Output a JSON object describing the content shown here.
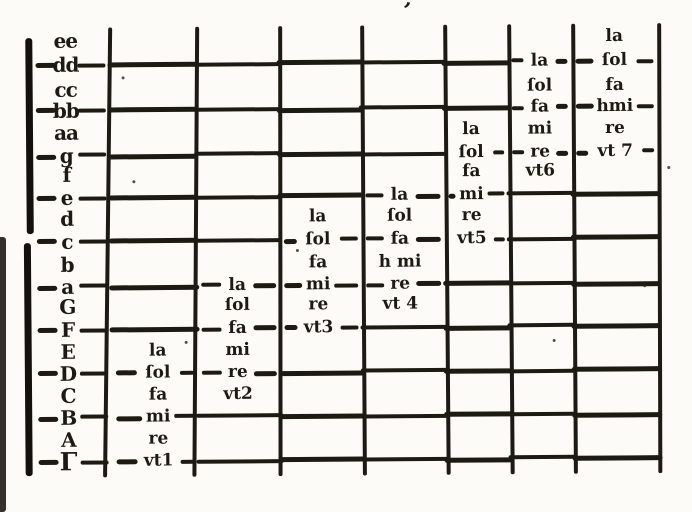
{
  "palette": {
    "ink": "#1d1a13",
    "paper": "#fcfbf7"
  },
  "marks": {
    "top_mark": "’"
  },
  "gamut": {
    "hexachord_uts": [
      "vt1",
      "vt2",
      "vt3",
      "vt 4",
      "vt5",
      "vt6",
      "vt 7"
    ],
    "syllable_order": [
      "vt",
      "re",
      "mi",
      "fa",
      "ſol",
      "la"
    ]
  },
  "rows": [
    {
      "letter": "ee",
      "line": false,
      "cells": {
        "h7": "la"
      }
    },
    {
      "letter": "dd",
      "line": true,
      "cells": {
        "h6": "la",
        "h7": "ſol"
      }
    },
    {
      "letter": "cc",
      "line": false,
      "cells": {
        "h6": "ſol",
        "h7": "fa"
      }
    },
    {
      "letter": "bb",
      "line": true,
      "cells": {
        "h6": "fa",
        "h7": "hmi"
      }
    },
    {
      "letter": "aa",
      "line": false,
      "cells": {
        "h5": "la",
        "h6": "mi",
        "h7": "re"
      }
    },
    {
      "letter": "g",
      "line": true,
      "cells": {
        "h5": "ſol",
        "h6": "re",
        "h7": "vt 7"
      }
    },
    {
      "letter": "f",
      "line": false,
      "cells": {
        "h5": "fa",
        "h6": "vt6"
      }
    },
    {
      "letter": "e",
      "line": true,
      "cells": {
        "h4": "la",
        "h5": "mi"
      }
    },
    {
      "letter": "d",
      "line": false,
      "cells": {
        "h3": "la",
        "h4": "ſol",
        "h5": "re"
      }
    },
    {
      "letter": "c",
      "line": true,
      "cells": {
        "h3": "ſol",
        "h4": "fa",
        "h5": "vt5"
      }
    },
    {
      "letter": "b",
      "line": false,
      "cells": {
        "h3": "fa",
        "h4": "h mi"
      }
    },
    {
      "letter": "a",
      "line": true,
      "cells": {
        "h2": "la",
        "h3": "mi",
        "h4": "re"
      }
    },
    {
      "letter": "G",
      "line": false,
      "cells": {
        "h2": "ſol",
        "h3": "re",
        "h4": "vt 4"
      }
    },
    {
      "letter": "F",
      "line": true,
      "cells": {
        "h2": "fa",
        "h3": "vt3"
      }
    },
    {
      "letter": "E",
      "line": false,
      "cells": {
        "h1": "la",
        "h2": "mi"
      }
    },
    {
      "letter": "D",
      "line": true,
      "cells": {
        "h1": "ſol",
        "h2": "re"
      }
    },
    {
      "letter": "C",
      "line": false,
      "cells": {
        "h1": "fa",
        "h2": "vt2"
      }
    },
    {
      "letter": "B",
      "line": true,
      "cells": {
        "h1": "mi"
      }
    },
    {
      "letter": "A",
      "line": false,
      "cells": {
        "h1": "re"
      }
    },
    {
      "letter": "Γ",
      "line": true,
      "cells": {
        "h1": "vt1"
      }
    }
  ]
}
